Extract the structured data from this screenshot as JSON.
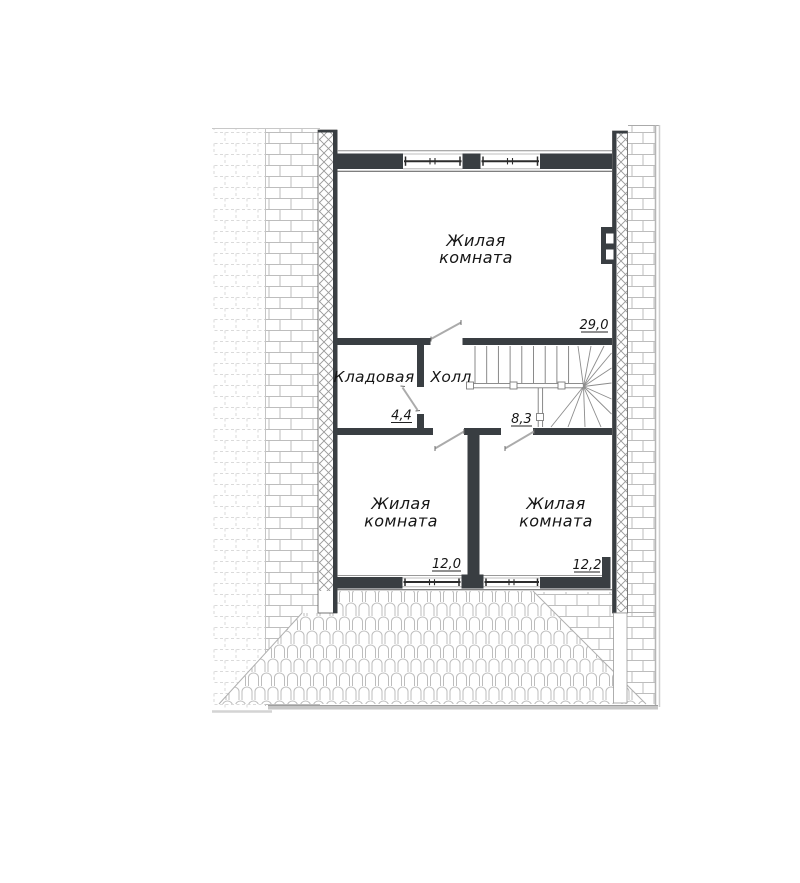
{
  "floor_plan": {
    "type": "attic floor plan",
    "rooms": [
      {
        "id": "living-room-top",
        "name_line1": "Жилая",
        "name_line2": "комната",
        "area": "29,0"
      },
      {
        "id": "storage-room",
        "name": "Кладовая",
        "area": "4,4"
      },
      {
        "id": "hall",
        "name": "Холл",
        "area": "8,3"
      },
      {
        "id": "living-room-bottom-left",
        "name_line1": "Жилая",
        "name_line2": "комната",
        "area": "12,0"
      },
      {
        "id": "living-room-bottom-right",
        "name_line1": "Жилая",
        "name_line2": "комната",
        "area": "12,2"
      }
    ],
    "colors": {
      "wall_dark": "#393e42",
      "thin_line": "#555555",
      "roof_pattern": "#bdbdbd",
      "roof_pattern_faded": "#dadada",
      "insulation_hatch": "#989898",
      "stair_line": "#7d7d7d",
      "door_line": "#ababab",
      "eave_gray": "#c7c7c7",
      "text": "#161616"
    }
  }
}
